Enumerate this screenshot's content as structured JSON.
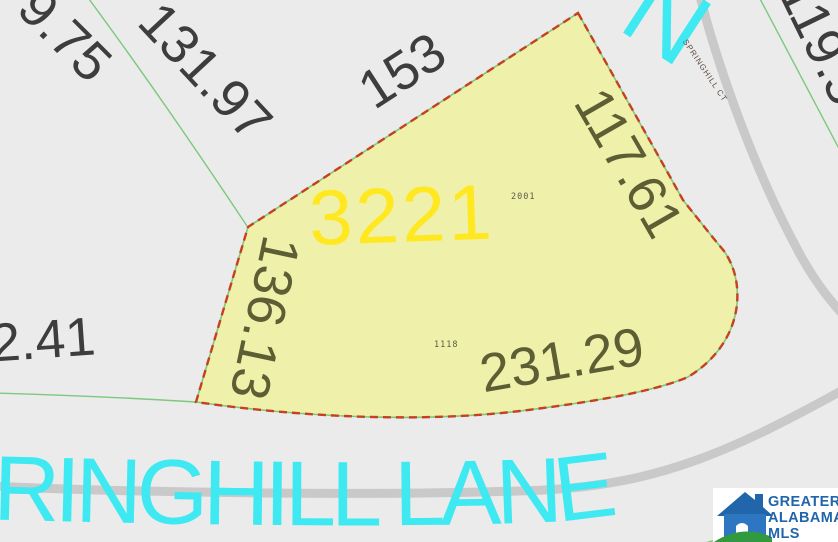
{
  "map": {
    "parcel": {
      "lot_number": "3221",
      "ids": {
        "upper": "2001",
        "lower": "1118"
      }
    },
    "measurements": {
      "northwest_far": "9.75",
      "northwest": "131.97",
      "north": "153",
      "northeast": "119.5",
      "east": "117.61",
      "west": "136.13",
      "south": "231.29",
      "southwest": "2.41"
    },
    "streets": {
      "main": "SPRINGHILL LANE",
      "court": "SPRINGHILL CT",
      "partial_north_letter": "N"
    }
  },
  "logo": {
    "line1": "GREATER",
    "line2": "ALABAMA",
    "line3": "MLS"
  },
  "colors": {
    "bg": "#ebebeb",
    "parcel-fill": "#eff0a9",
    "parcel-stroke": "#c5401f",
    "green-line": "#7dc87d",
    "road": "#c9c9c9",
    "street-cyan": "#3fe9f2",
    "label-gray": "#3d3d3d",
    "label-olive": "#5e5e35",
    "label-id": "#5c5c4a",
    "ct-label": "#5e4b41",
    "lot-yellow": "#ffe81f",
    "logo-blue": "#2166ab",
    "logo-blue-light": "#2d77c2",
    "logo-green": "#31993e"
  }
}
